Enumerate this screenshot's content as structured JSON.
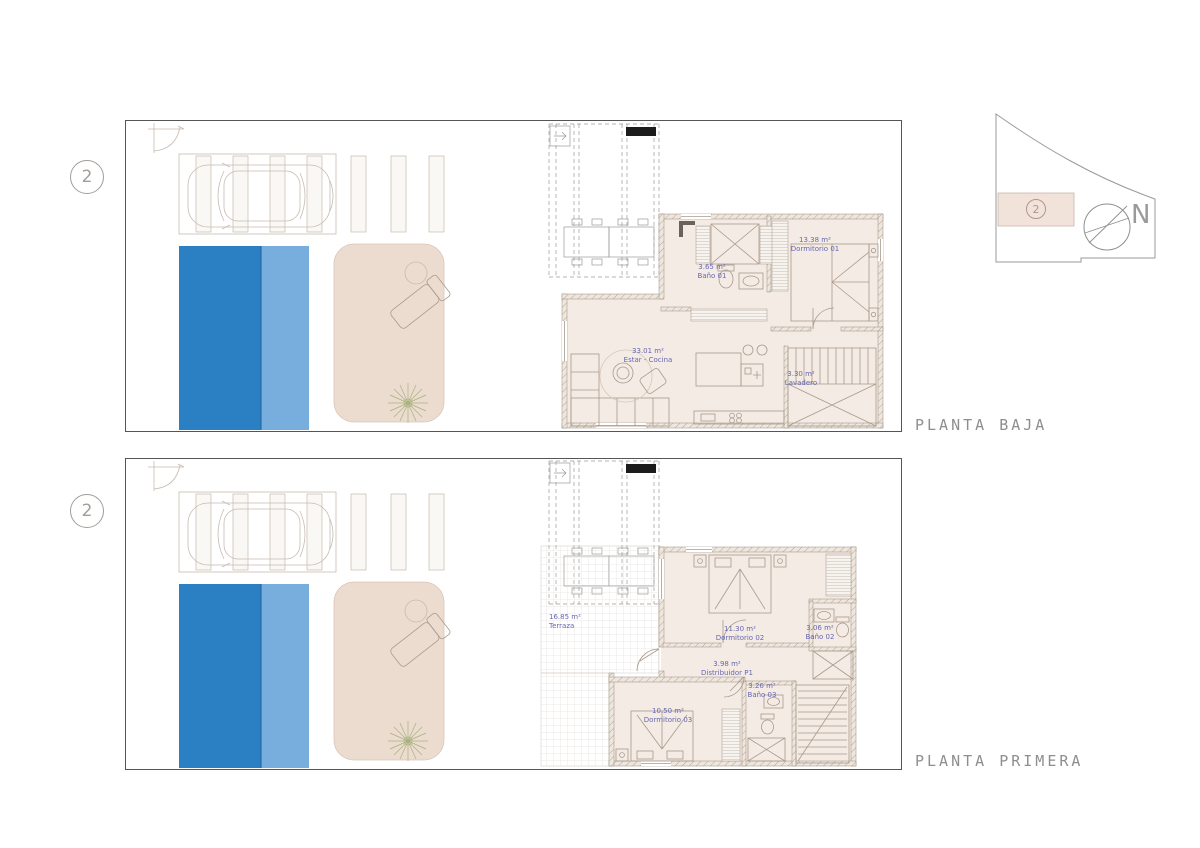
{
  "sheet": {
    "background": "#ffffff"
  },
  "compass": {
    "marker": "2",
    "north_label": "N"
  },
  "plans": [
    {
      "marker": "2",
      "title": "PLANTA BAJA",
      "rooms": [
        {
          "area": "3.65 m²",
          "name": "Baño 01"
        },
        {
          "area": "13.38 m²",
          "name": "Dormitorio 01"
        },
        {
          "area": "33.01 m²",
          "name": "Estar - Cocina"
        },
        {
          "area": "3.30 m²",
          "name": "Lavadero"
        }
      ]
    },
    {
      "marker": "2",
      "title": "PLANTA PRIMERA",
      "rooms": [
        {
          "area": "16.85 m²",
          "name": "Terraza"
        },
        {
          "area": "11.30 m²",
          "name": "Dormitorio 02"
        },
        {
          "area": "3.06 m²",
          "name": "Baño 02"
        },
        {
          "area": "3.98 m²",
          "name": "Distribuidor P1"
        },
        {
          "area": "3.26 m²",
          "name": "Baño 03"
        },
        {
          "area": "10.50 m²",
          "name": "Dormitorio 03"
        }
      ]
    }
  ],
  "colors": {
    "pool_dark": "#2b80c3",
    "pool_light": "#78aedd",
    "deck_beige": "#ecdccf",
    "floor_beige": "#f4ebe4",
    "label_blue": "#6767b1",
    "title_gray": "#8e8e8e"
  }
}
